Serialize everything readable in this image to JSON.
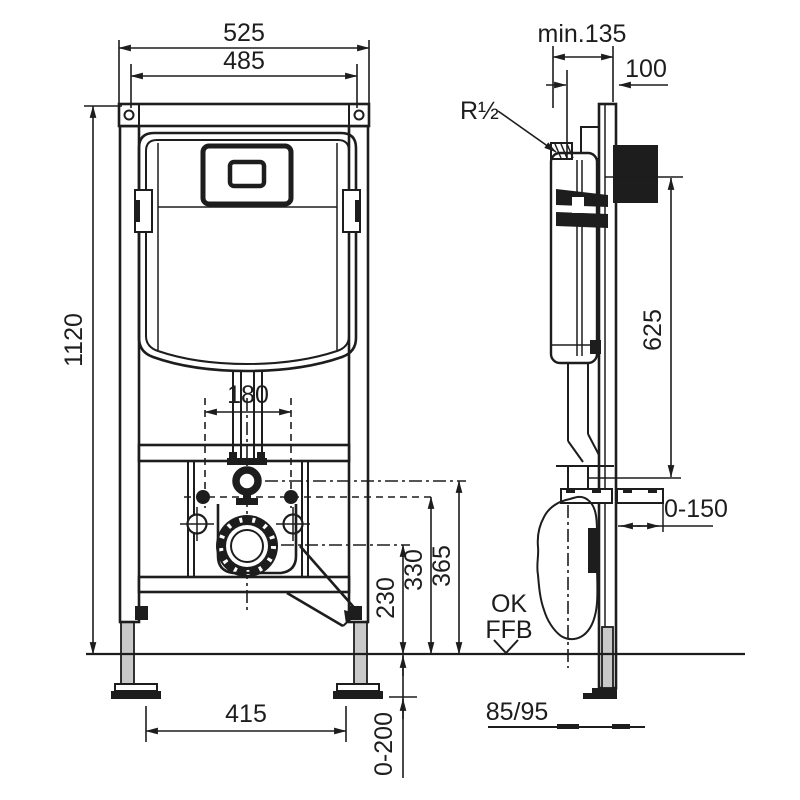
{
  "page": {
    "background": "#ffffff",
    "ink_color": "#1d1d1d",
    "metal_fill": "#c9c9c9"
  },
  "drawing": {
    "kind": "wc-installation-frame-technical-drawing",
    "views": {
      "front": {
        "title": "front view",
        "dimensions": {
          "overall_width": "525",
          "inner_width": "485",
          "frame_height": "1120",
          "flush_pipe_spacing": "180",
          "outlet_center_height": "230",
          "fixing_bolt_height": "330",
          "flush_elbow_height": "365",
          "foot_spacing": "415",
          "foot_height_adjustment": "0-200"
        }
      },
      "side": {
        "title": "side view",
        "dimensions": {
          "min_installation_depth": "min.135",
          "top_offset": "100",
          "water_supply_thread": "R½",
          "wall_bracket_height": "625",
          "bracket_depth_adjustment": "0-150",
          "outlet_pipe_diameter": "85/95"
        },
        "floor_reference": {
          "line1": "OK",
          "line2": "FFB"
        }
      }
    }
  }
}
